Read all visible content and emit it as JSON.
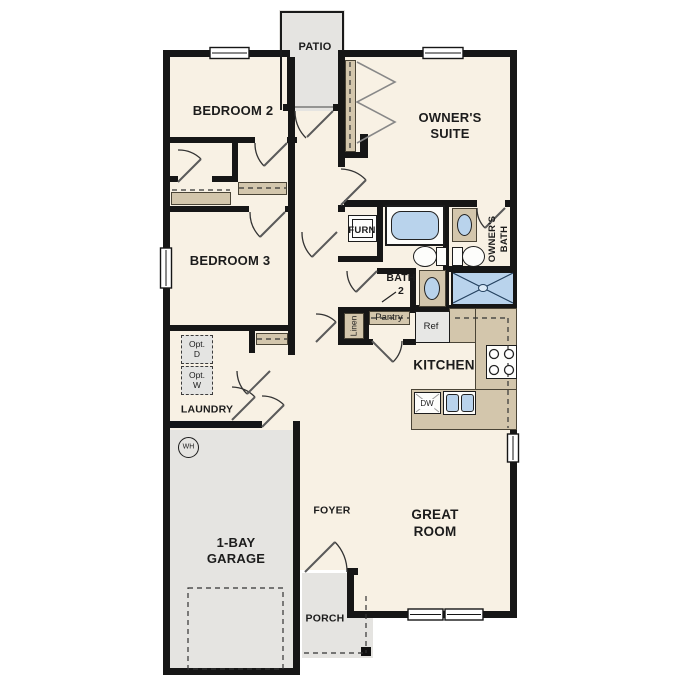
{
  "plan": {
    "patio": "PATIO",
    "bedroom2": "BEDROOM 2",
    "owners_suite": {
      "line1": "OWNER'S",
      "line2": "SUITE"
    },
    "bedroom3": "BEDROOM 3",
    "furnace": "FURN",
    "bath2": {
      "line1": "BATH",
      "line2": "2"
    },
    "owners_bath": {
      "line1": "OWNER'S",
      "line2": "BATH"
    },
    "linen": "Linen",
    "pantry": "Pantry",
    "fridge": "Ref",
    "kitchen": "KITCHEN",
    "dishwasher": "DW",
    "opt_dryer": {
      "line1": "Opt.",
      "line2": "D"
    },
    "opt_washer": {
      "line1": "Opt.",
      "line2": "W"
    },
    "laundry": "LAUNDRY",
    "water_heater": "WH",
    "garage": {
      "line1": "1-BAY",
      "line2": "GARAGE"
    },
    "foyer": "FOYER",
    "great_room": {
      "line1": "GREAT",
      "line2": "ROOM"
    },
    "porch": "PORCH"
  },
  "colors": {
    "floor": "#f8f1e4",
    "outdoor_gray": "#e5e4e1",
    "wall": "#161616",
    "fixture_blue": "#b9d3ec",
    "cabinet_tan": "#d3c6ac"
  }
}
